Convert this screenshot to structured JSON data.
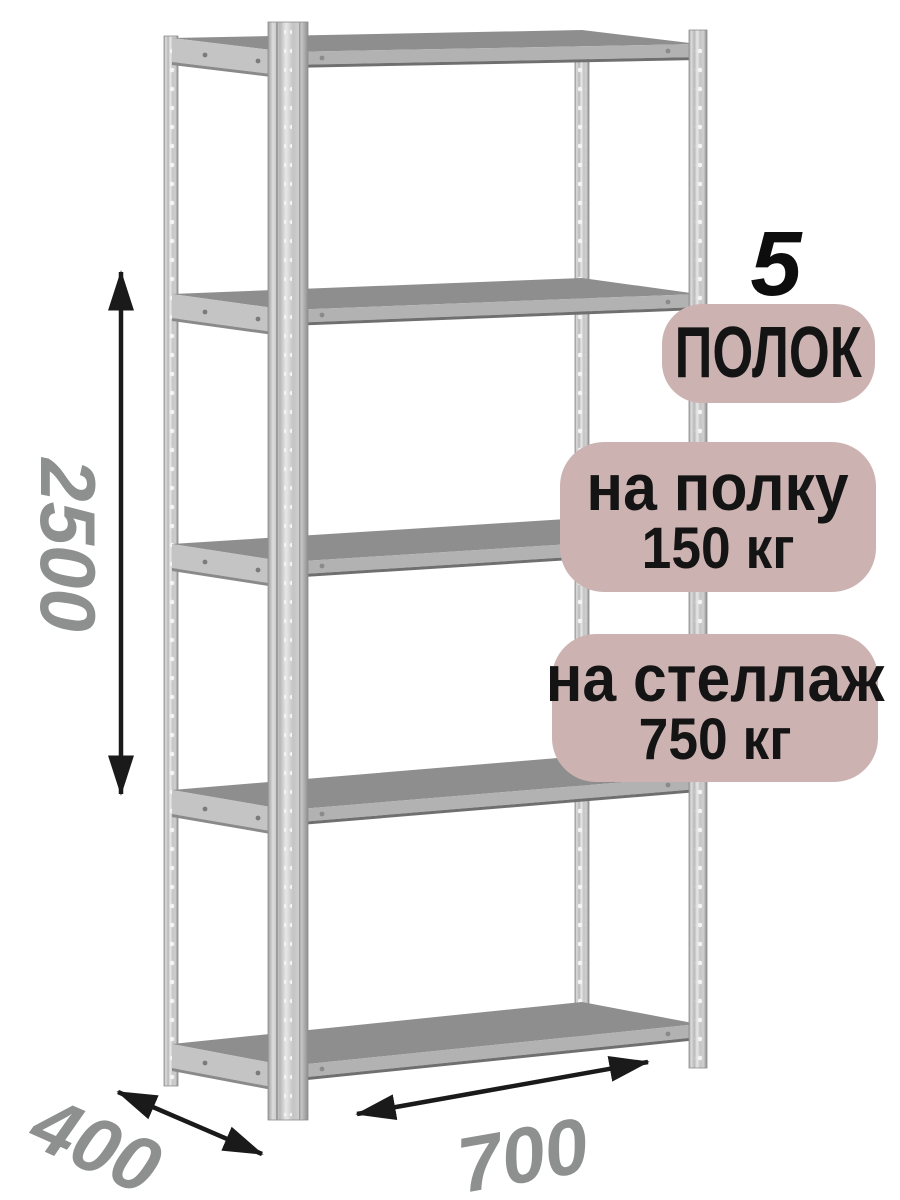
{
  "product": {
    "kind": "metal shelving rack infographic"
  },
  "dimensions": {
    "height": "2500",
    "depth": "400",
    "width": "700"
  },
  "badges": {
    "shelves": {
      "number": "5",
      "label": "ПОЛОК"
    },
    "shelf_load": {
      "line1": "на полку",
      "line2": "150 кг"
    },
    "rack_load": {
      "line1": "на стеллаж",
      "line2": "750 кг"
    }
  },
  "colors": {
    "background": "#ffffff",
    "badge_bg": "#cdb2b2",
    "badge_text": "#141414",
    "dimension_text": "#8e9090",
    "arrow": "#1a1a1a",
    "metal_light": "#d8d8d8",
    "metal_mid": "#b2b2b2",
    "metal_dark": "#8e8e8e"
  }
}
